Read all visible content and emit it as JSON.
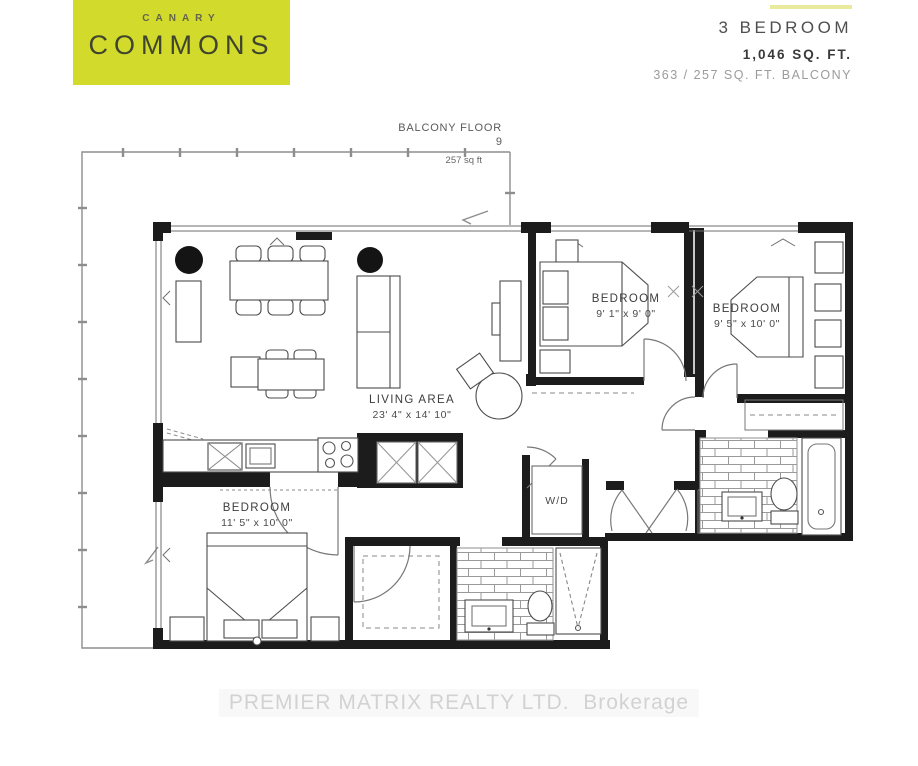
{
  "logo": {
    "top": "CANARY",
    "main": "COMMONS"
  },
  "unit": {
    "type": "3 BEDROOM",
    "area": "1,046 SQ. FT.",
    "balcony_area": "363 / 257 SQ. FT. BALCONY"
  },
  "balcony": {
    "title": "BALCONY FLOOR",
    "floor": "9",
    "area": "257 sq ft"
  },
  "rooms": {
    "living": {
      "name": "LIVING AREA",
      "dims": "23' 4\" x 14' 10\""
    },
    "bedroom_middle": {
      "name": "BEDROOM",
      "dims": "9' 1\" x 9' 0\""
    },
    "bedroom_right": {
      "name": "BEDROOM",
      "dims": "9' 5\" x 10' 0\""
    },
    "bedroom_lower": {
      "name": "BEDROOM",
      "dims": "11' 5\" x 10' 0\""
    },
    "laundry": {
      "name": "W/D"
    }
  },
  "watermark": "PREMIER MATRIX REALTY LTD.  Brokerage",
  "colors": {
    "brand": "#d2da2c",
    "brand_text_small": "#63654a",
    "brand_text_main": "#3f442e",
    "accent_bar": "#e9ea9b",
    "wall": "#1c1c1c"
  }
}
